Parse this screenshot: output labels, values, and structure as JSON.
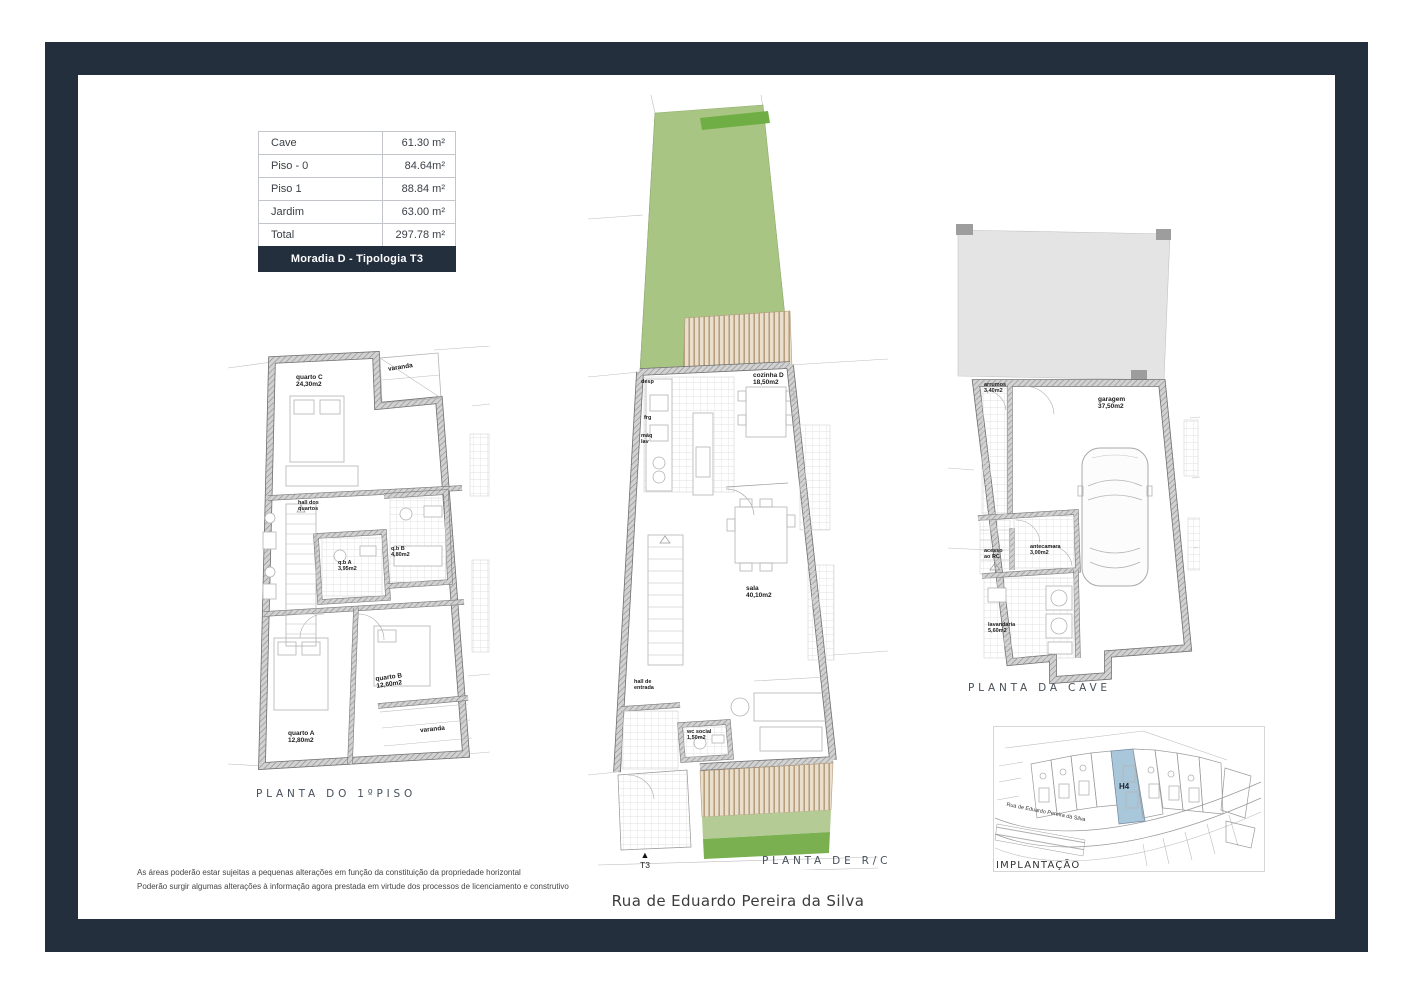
{
  "page": {
    "frame_color": "#232f3d",
    "background": "#ffffff"
  },
  "colors": {
    "garden_green": "#a9c584",
    "garden_accent_green": "#6fae44",
    "deck_wood": "#eadfcc",
    "highlight_lot_blue": "#a9c7da",
    "neighbor_block_gray": "#e4e4e4"
  },
  "area_table": {
    "header": "Moradia D  - Tipologia T3",
    "rows": [
      {
        "label": "Cave",
        "value": "61.30 m²"
      },
      {
        "label": "Piso - 0",
        "value": "84.64m²"
      },
      {
        "label": "Piso 1",
        "value": "88.84 m²"
      },
      {
        "label": "Jardim",
        "value": "63.00 m²"
      },
      {
        "label": "Total",
        "value": "297.78 m²"
      }
    ]
  },
  "first_floor_plan": {
    "title": "PLANTA DO 1ºPISO",
    "rooms": {
      "quarto_c": {
        "name": "quarto C",
        "area": "24,30m2"
      },
      "varanda_top": {
        "name": "varanda"
      },
      "hall": {
        "line1": "hall dos",
        "line2": "quartos"
      },
      "qb_a": {
        "name": "q.b A",
        "area": "3,95m2"
      },
      "qb_b": {
        "name": "q.b B",
        "area": "4,80m2"
      },
      "quarto_b": {
        "name": "quarto B",
        "area": "12,60m2"
      },
      "quarto_a": {
        "name": "quarto A",
        "area": "12,80m2"
      },
      "varanda_bottom": {
        "name": "varanda"
      }
    }
  },
  "ground_floor_plan": {
    "title": "PLANTA DE R/C",
    "marker_label": "T3",
    "rooms": {
      "desp": {
        "name": "desp"
      },
      "frg": {
        "name": "frg"
      },
      "maq_lav": {
        "line1": "máq",
        "line2": "lav"
      },
      "cozinha": {
        "name": "cozinha D",
        "area": "18,50m2"
      },
      "sala": {
        "name": "sala",
        "area": "40,10m2"
      },
      "hall_entrada": {
        "line1": "hall de",
        "line2": "entrada"
      },
      "wc_social": {
        "name": "wc social",
        "area": "1,50m2"
      }
    }
  },
  "basement_plan": {
    "title": "PLANTA DA CAVE",
    "rooms": {
      "arrumos": {
        "name": "arrumos",
        "area": "3,40m2"
      },
      "garagem": {
        "name": "garagem",
        "area": "37,50m2"
      },
      "acesso": {
        "line1": "acesso",
        "line2": "ao RC"
      },
      "antecamara": {
        "name": "antecamara",
        "area": "3,00m2"
      },
      "lavandaria": {
        "name": "lavandaria",
        "area": "5,60m2"
      }
    }
  },
  "site_plan": {
    "title": "IMPLANTAÇÃO",
    "lot_label": "H4",
    "road_label": "Rua de Eduardo Pereira da Silva"
  },
  "street_name": "Rua de Eduardo Pereira da Silva",
  "disclaimer": {
    "line1": "As áreas poderão estar sujeitas a pequenas alterações em função da constituição da propriedade horizontal",
    "line2": "Poderão surgir algumas alterações à informação agora prestada em virtude dos processos de licenciamento e construtivo"
  }
}
